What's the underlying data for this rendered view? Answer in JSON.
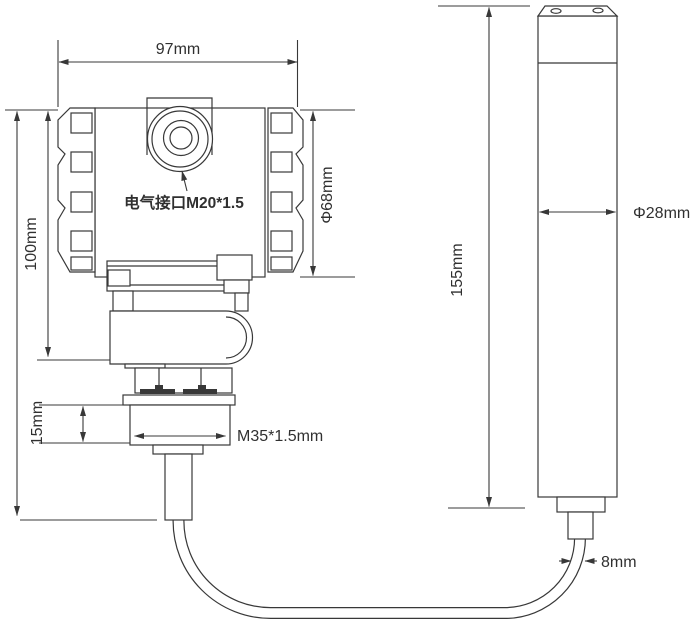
{
  "drawing": {
    "subject": "level-transmitter-dimension-drawing",
    "colors": {
      "line": "#383838",
      "text": "#303030",
      "background": "#ffffff"
    },
    "labels": {
      "housing_width": "97mm",
      "housing_height": "100mm",
      "housing_diameter": "Φ68mm",
      "electrical_port": "电气接口M20*1.5",
      "gland_height": "15mm",
      "thread_spec": "M35*1.5mm",
      "probe_length": "155mm",
      "probe_diameter": "Φ28mm",
      "cable_diameter": "8mm"
    }
  }
}
